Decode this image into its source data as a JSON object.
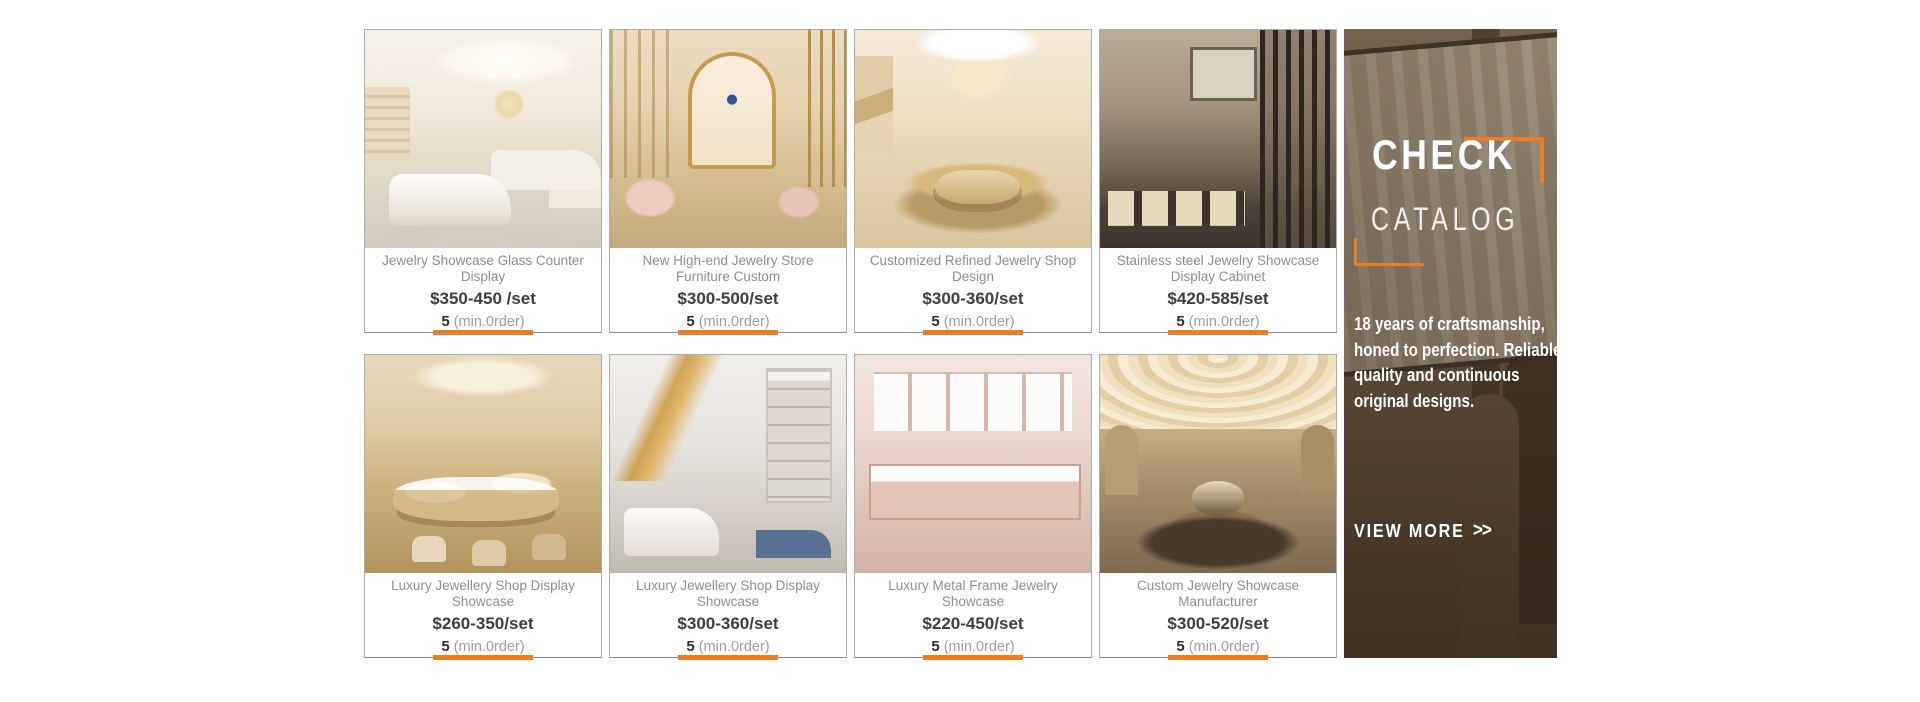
{
  "theme": {
    "accent_orange": "#ED7D23",
    "card_border_gray": "#adadad"
  },
  "cards": [
    {
      "title": "Jewelry Showcase Glass Counter Display",
      "price": "$350-450 /set",
      "min_qty": "5",
      "min_label": "(min.0rder)"
    },
    {
      "title": "New High-end Jewelry Store Furniture Custom",
      "price": "$300-500/set",
      "min_qty": "5",
      "min_label": "(min.0rder)"
    },
    {
      "title": "Customized Refined Jewelry Shop Design",
      "price": "$300-360/set",
      "min_qty": "5",
      "min_label": "(min.0rder)"
    },
    {
      "title": "Stainless steel Jewelry Showcase Display Cabinet",
      "price": "$420-585/set",
      "min_qty": "5",
      "min_label": "(min.0rder)"
    },
    {
      "title": "Luxury Jewellery Shop Display Showcase",
      "price": "$260-350/set",
      "min_qty": "5",
      "min_label": "(min.0rder)"
    },
    {
      "title": "Luxury Jewellery Shop Display Showcase",
      "price": "$300-360/set",
      "min_qty": "5",
      "min_label": "(min.0rder)"
    },
    {
      "title": "Luxury Metal Frame Jewelry Showcase",
      "price": "$220-450/set",
      "min_qty": "5",
      "min_label": "(min.0rder)"
    },
    {
      "title": "Custom Jewelry Showcase Manufacturer",
      "price": "$300-520/set",
      "min_qty": "5",
      "min_label": "(min.0rder)"
    }
  ],
  "banner": {
    "heading_line1": "CHECK",
    "heading_line2": "CATALOG",
    "description": "18 years of craftsmanship, honed to perfection. Reliable quality and continuous original designs.",
    "view_more_label": "VIEW MORE",
    "view_more_icon": ">>"
  }
}
